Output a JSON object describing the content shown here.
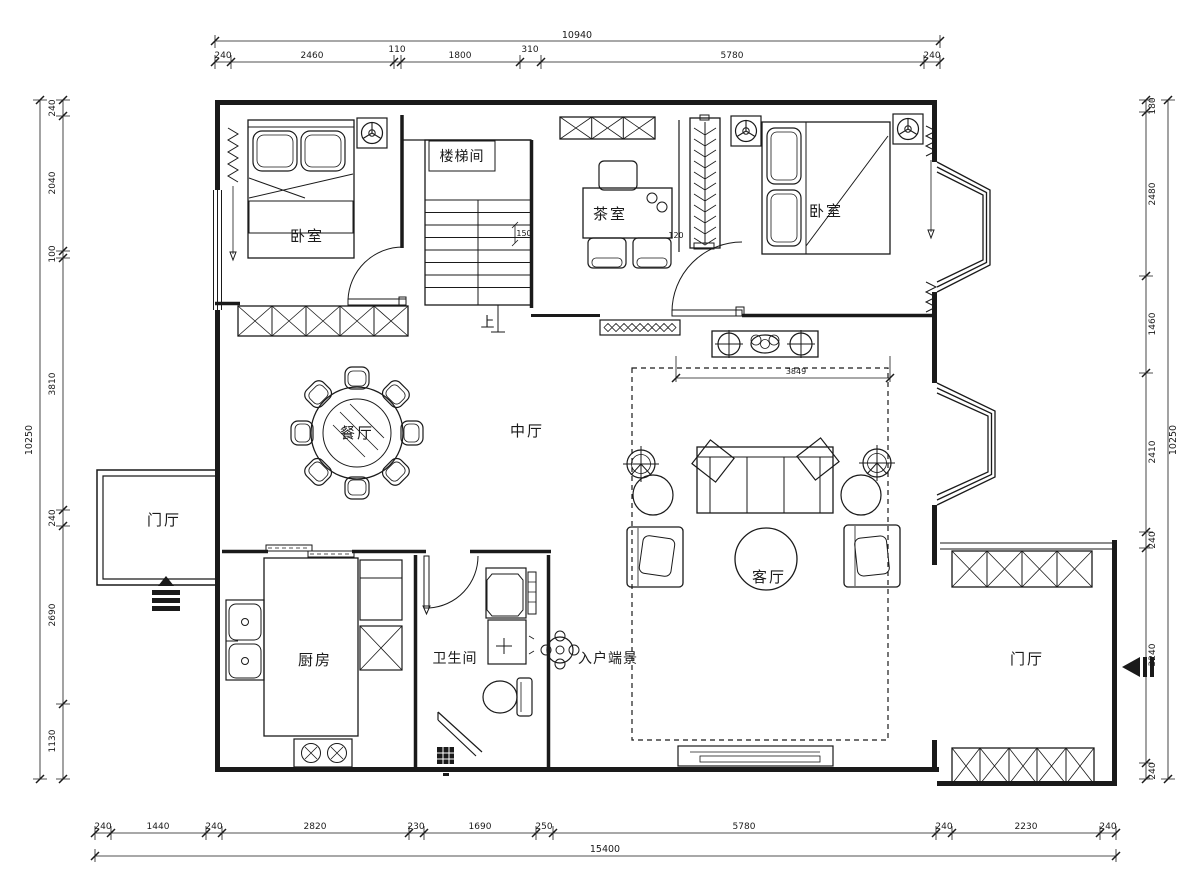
{
  "drawing": {
    "type": "residential-floor-plan",
    "language": "zh-CN",
    "colors": {
      "line": "#1a1a1a",
      "background": "#ffffff"
    }
  },
  "rooms": {
    "bedroom_left": "卧室",
    "bedroom_right": "卧室",
    "stairwell": "楼梯间",
    "stairs_up": "上",
    "tea_room": "茶室",
    "central_hall": "中厅",
    "dining_room": "餐厅",
    "foyer_left": "门厅",
    "foyer_right": "门厅",
    "kitchen": "厨房",
    "bathroom": "卫生间",
    "entry_vista": "入户端景",
    "living_room": "客厅"
  },
  "dims": {
    "top": {
      "total": "10940",
      "segments": [
        "240",
        "2460",
        "110",
        "1800",
        "310",
        "5780",
        "240"
      ]
    },
    "bottom": {
      "total": "15400",
      "segments": [
        "240",
        "1440",
        "240",
        "2820",
        "230",
        "1690",
        "250",
        "5780",
        "240",
        "2230",
        "240"
      ]
    },
    "left": {
      "total": "10250",
      "segments": [
        "240",
        "2040",
        "100",
        "3810",
        "240",
        "2690",
        "1130"
      ]
    },
    "right": {
      "total": "10250",
      "segments": [
        "180",
        "2480",
        "1460",
        "2410",
        "240",
        "3240",
        "240"
      ]
    },
    "inner": {
      "living_width": "3849",
      "stair": "150",
      "wall": "120"
    }
  }
}
